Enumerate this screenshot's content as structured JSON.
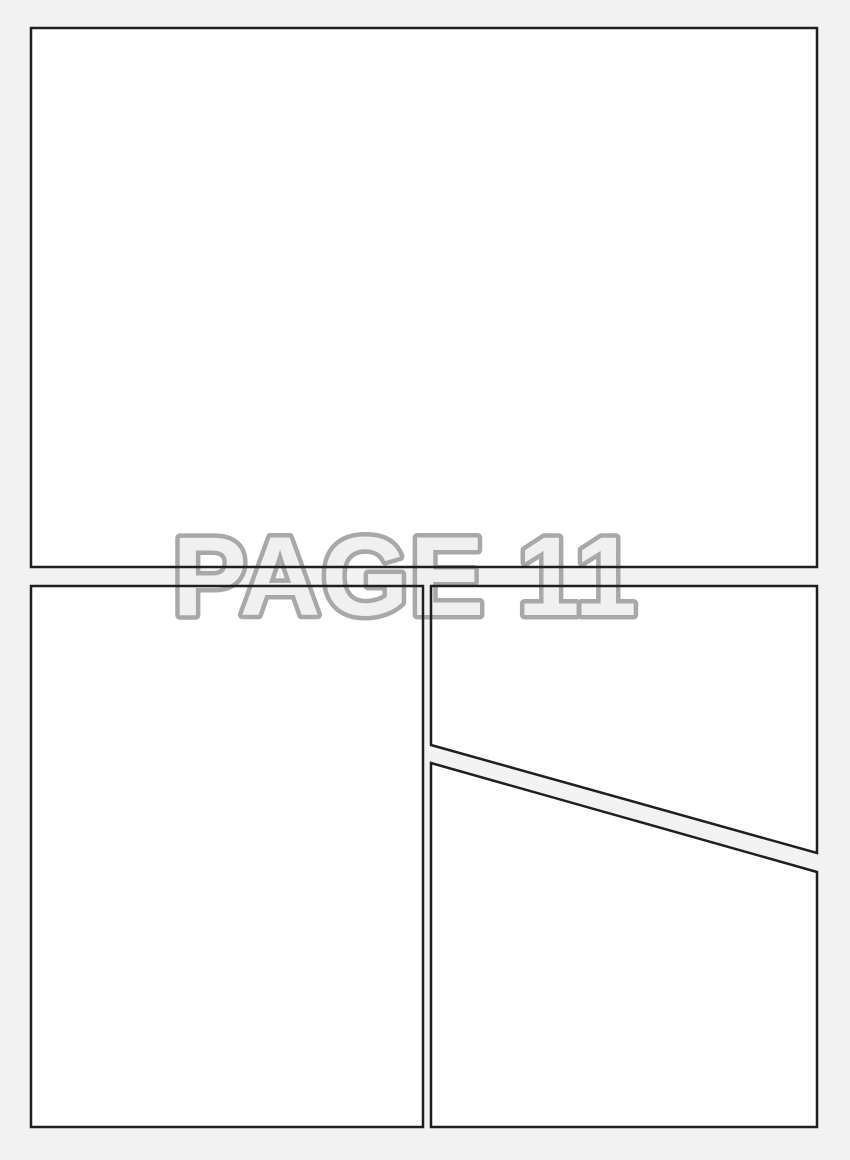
{
  "page": {
    "label": "PAGE 11",
    "background_color": "#f2f2f2",
    "panel_fill": "#ffffff",
    "panel_border_color": "#1f1f1f",
    "panel_border_width": 2.5,
    "label_fill": "#f0f0f0",
    "label_stroke": "#a8a8a8",
    "label_stroke_width": 9,
    "label_center_x": 405,
    "label_baseline_y": 615
  },
  "panels": [
    {
      "id": "panel-top",
      "shape": "rect",
      "x": 31,
      "y": 28,
      "width": 786,
      "height": 539
    },
    {
      "id": "panel-bottom-left",
      "shape": "rect",
      "x": 31,
      "y": 586,
      "width": 392,
      "height": 541
    },
    {
      "id": "panel-bottom-right-upper",
      "shape": "polygon",
      "points": "431,586 817,586 817,853 431,745"
    },
    {
      "id": "panel-bottom-right-lower",
      "shape": "polygon",
      "points": "431,763 817,872 817,1127 431,1127"
    }
  ]
}
